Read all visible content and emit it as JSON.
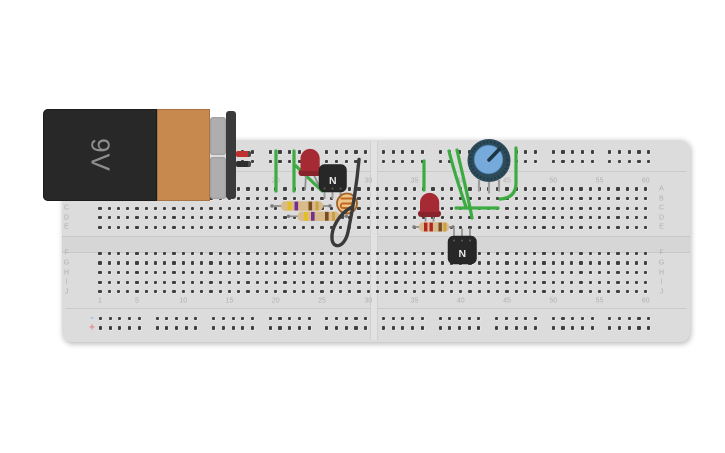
{
  "scene": {
    "background": "#ffffff"
  },
  "breadboard": {
    "board_color": "#dcdcdc",
    "hole_color": "#3e3e3e",
    "column_labels": [
      "1",
      "5",
      "10",
      "15",
      "20",
      "25",
      "30",
      "35",
      "40",
      "45",
      "50",
      "55",
      "60"
    ],
    "row_labels_top": [
      "A",
      "B",
      "C",
      "D",
      "E"
    ],
    "row_labels_bottom": [
      "F",
      "G",
      "H",
      "I",
      "J"
    ],
    "rail_negative_marker": "-",
    "rail_positive_marker": "+"
  },
  "battery": {
    "label": "9V",
    "body_color": "#282828",
    "band_color": "#c8894e",
    "positive_lead_color": "#c03030",
    "negative_lead_color": "#2e2e2e"
  },
  "components": {
    "led1": {
      "type": "red LED",
      "color": "#a62a33"
    },
    "led2": {
      "type": "red LED",
      "color": "#a62a33"
    },
    "transistor1": {
      "type": "NPN transistor",
      "label": "N"
    },
    "transistor2": {
      "type": "NPN transistor",
      "label": "N"
    },
    "resistor1": {
      "type": "resistor",
      "bands": [
        "yellow",
        "violet",
        "brown",
        "gold"
      ]
    },
    "resistor2": {
      "type": "resistor",
      "bands": [
        "yellow",
        "violet",
        "brown",
        "gold"
      ]
    },
    "resistor3": {
      "type": "resistor",
      "bands": [
        "red",
        "red",
        "brown",
        "gold"
      ]
    },
    "photoresistor": {
      "type": "LDR",
      "body_color": "#eec488"
    },
    "potentiometer": {
      "type": "potentiometer",
      "knob_color": "#76aadb",
      "body_color": "#2d4b59"
    }
  },
  "wires": {
    "green_color": "#3cab42",
    "black_color": "#3a3a3a",
    "green_wire_count": 8,
    "black_wire_count": 1
  }
}
